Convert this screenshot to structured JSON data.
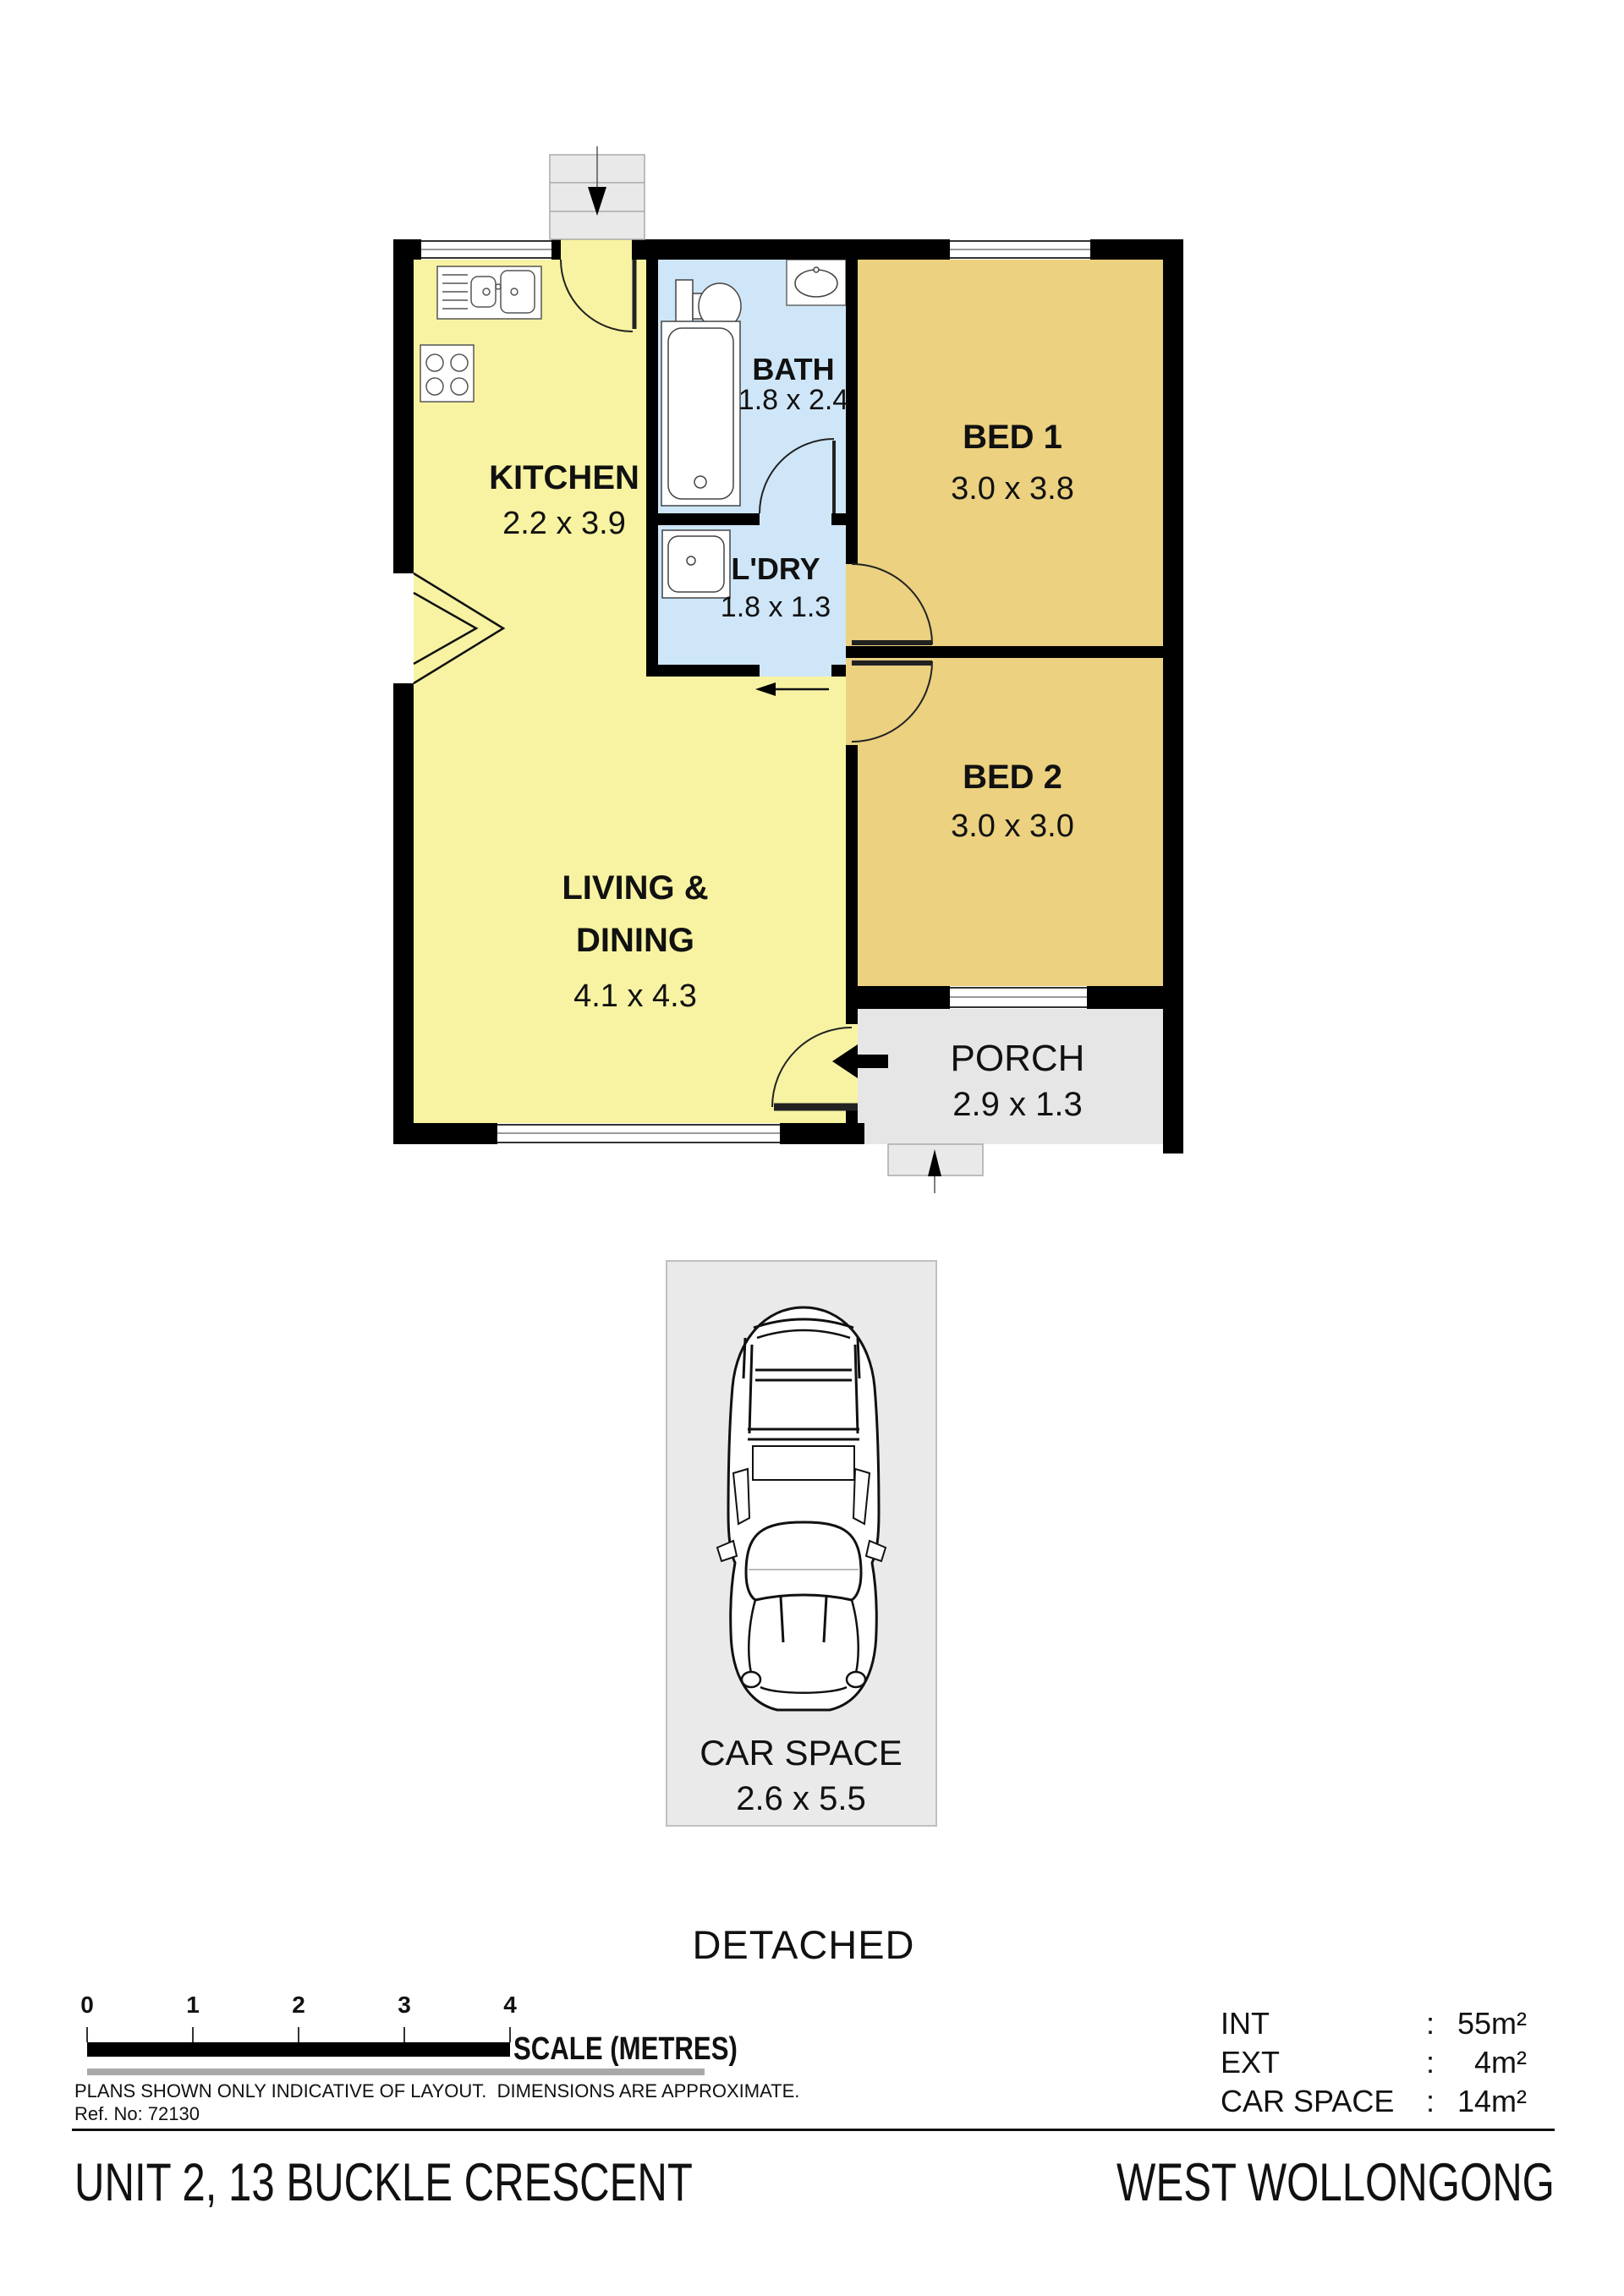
{
  "plan": {
    "rooms": {
      "kitchen": {
        "label": "KITCHEN",
        "dims": "2.2 x 3.9"
      },
      "bath": {
        "label": "BATH",
        "dims": "1.8 x 2.4"
      },
      "laundry": {
        "label": "L'DRY",
        "dims": "1.8 x 1.3"
      },
      "bed1": {
        "label": "BED 1",
        "dims": "3.0 x 3.8"
      },
      "bed2": {
        "label": "BED 2",
        "dims": "3.0 x 3.0"
      },
      "living": {
        "label_line1": "LIVING &",
        "label_line2": "DINING",
        "dims": "4.1 x 4.3"
      },
      "porch": {
        "label": "PORCH",
        "dims": "2.9 x 1.3"
      }
    }
  },
  "car_space": {
    "label": "CAR SPACE",
    "dims": "2.6 x 5.5"
  },
  "building_type": "DETACHED",
  "scale_bar": {
    "ticks": [
      "0",
      "1",
      "2",
      "3",
      "4"
    ],
    "label": "SCALE (METRES)"
  },
  "notes": {
    "disclaimer": "PLANS SHOWN ONLY INDICATIVE OF LAYOUT.  DIMENSIONS ARE APPROXIMATE.",
    "ref": "Ref. No: 72130"
  },
  "areas": {
    "rows": [
      {
        "label": "INT",
        "sep": ":",
        "value": "55m²"
      },
      {
        "label": "EXT",
        "sep": ":",
        "value": "4m²"
      },
      {
        "label": "CAR SPACE",
        "sep": ":",
        "value": "14m²"
      }
    ]
  },
  "footer": {
    "address": "UNIT 2, 13 BUCKLE CRESCENT",
    "locality": "WEST WOLLONGONG"
  },
  "colors": {
    "room_yellow": "#f7f3a2",
    "room_tan": "#ebd180",
    "room_blue": "#cee6f8",
    "porch_grey": "#e6e6e6",
    "stair_grey": "#e9e9e9",
    "car_box_grey": "#eaeaea",
    "wall_black": "#000000"
  }
}
